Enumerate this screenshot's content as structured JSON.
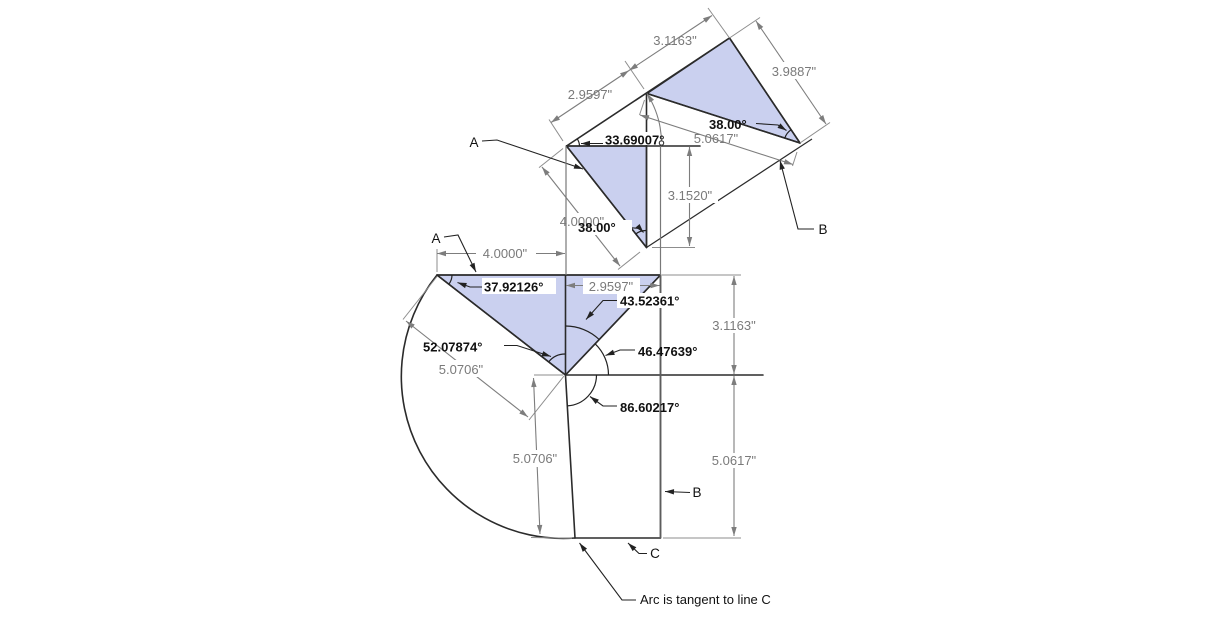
{
  "canvas": {
    "width": 1230,
    "height": 624,
    "background": "#ffffff"
  },
  "colors": {
    "part_fill": "#cad0ef",
    "edge": "#2b2b2b",
    "dimension_gray": "#7d7d7d",
    "text_gray": "#7a7a7a",
    "text_black": "#111111"
  },
  "upper_view": {
    "dims": {
      "edge_top_left": "2.9597\"",
      "edge_top_right": "3.1163\"",
      "edge_right": "3.9887\"",
      "edge_lower_right": "5.0617\"",
      "vertical_leg": "3.1520\"",
      "hypotenuse": "4.0000\""
    },
    "angles": {
      "reference_to_edge": "33.69007°",
      "apex": "38.00°",
      "right_corner": "38.00°"
    },
    "labels": {
      "a": "A",
      "b": "B"
    }
  },
  "lower_view": {
    "dims": {
      "top": "4.0000\"",
      "mid": "2.9597\"",
      "right_upper": "3.1163\"",
      "right_lower": "5.0617\"",
      "hypotenuse_aligned": "5.0706\"",
      "left_drop_aligned": "5.0706\""
    },
    "angles": {
      "top_left": "37.92126°",
      "apex_right_of_leg": "43.52361°",
      "apex_left_of_leg": "52.07874°",
      "hyp_to_horizontal": "46.47639°",
      "bottom": "86.60217°"
    },
    "labels": {
      "a": "A",
      "b": "B",
      "c": "C"
    }
  },
  "note": {
    "text": "Arc is tangent to line C"
  }
}
